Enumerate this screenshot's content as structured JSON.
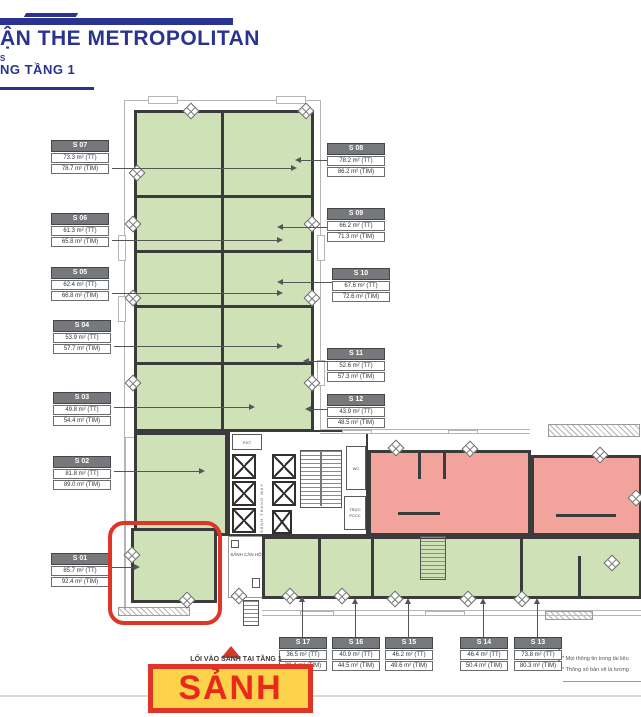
{
  "header": {
    "title": "ẬN THE METROPOLITAN",
    "fragment": "S",
    "floor": "NG TẦNG 1"
  },
  "units": [
    {
      "id": "S 01",
      "tt": "85.7 m² (TT)",
      "tim": "92.4 m² (TIM)"
    },
    {
      "id": "S 02",
      "tt": "81.8 m² (TT)",
      "tim": "89.0 m² (TIM)"
    },
    {
      "id": "S 03",
      "tt": "49.8 m² (TT)",
      "tim": "54.4 m² (TIM)"
    },
    {
      "id": "S 04",
      "tt": "53.9 m² (TT)",
      "tim": "57.7 m² (TIM)"
    },
    {
      "id": "S 05",
      "tt": "62.4 m² (TT)",
      "tim": "66.8 m² (TIM)"
    },
    {
      "id": "S 06",
      "tt": "61.3 m² (TT)",
      "tim": "65.8 m² (TIM)"
    },
    {
      "id": "S 07",
      "tt": "73.3 m² (TT)",
      "tim": "78.7 m² (TIM)"
    },
    {
      "id": "S 08",
      "tt": "78.2 m² (TT)",
      "tim": "86.2 m² (TIM)"
    },
    {
      "id": "S 09",
      "tt": "66.2 m² (TT)",
      "tim": "71.3 m² (TIM)"
    },
    {
      "id": "S 10",
      "tt": "67.6 m² (TT)",
      "tim": "72.6 m² (TIM)"
    },
    {
      "id": "S 11",
      "tt": "52.6 m² (TT)",
      "tim": "57.3 m² (TIM)"
    },
    {
      "id": "S 12",
      "tt": "43.9 m² (TT)",
      "tim": "48.5 m² (TIM)"
    },
    {
      "id": "S 13",
      "tt": "73.8 m² (TT)",
      "tim": "80.3 m² (TIM)"
    },
    {
      "id": "S 14",
      "tt": "46.4 m² (TT)",
      "tim": "50.4 m² (TIM)"
    },
    {
      "id": "S 15",
      "tt": "46.2 m² (TT)",
      "tim": "49.6 m² (TIM)"
    },
    {
      "id": "S 16",
      "tt": "40.9 m² (TT)",
      "tim": "44.5 m² (TIM)"
    },
    {
      "id": "S 17",
      "tt": "36.5 m² (TT)",
      "tim": "39.4 m² (TIM)"
    }
  ],
  "core": {
    "pkt": "P.KT",
    "lift_lobby": "SẢNH THANG MÁY",
    "wc": "WC",
    "pccc": "TRỰC PCCC",
    "lobby": "SẢNH CĂN HỘ"
  },
  "annotations": {
    "entrance": "LỐI VÀO SẢNH TẠI TẦNG 1",
    "callout": "SẢNH"
  },
  "footnotes": [
    "* Mọi thông tin trong tài liệu",
    "* Thông số bản vẽ là tương"
  ],
  "colors": {
    "brand_navy": "#2b3390",
    "unit_green": "#cfe1b6",
    "unit_pink": "#f2a49c",
    "highlight_red": "#e03427",
    "callout_yellow": "#fcd24b",
    "label_gray": "#77787b"
  }
}
